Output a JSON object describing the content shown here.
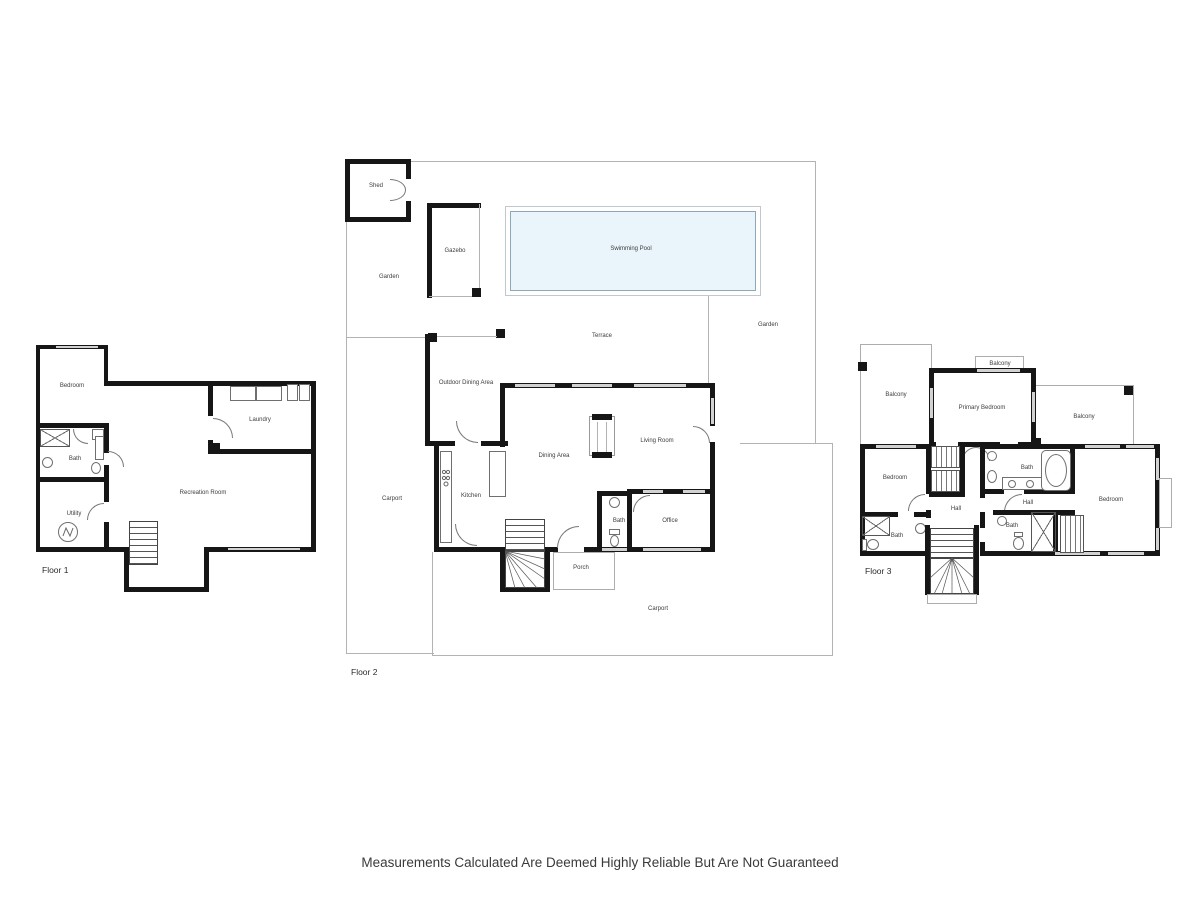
{
  "disclaimer": "Measurements Calculated Are Deemed Highly Reliable But Are Not Guaranteed",
  "floor1": {
    "name": "Floor 1",
    "rooms": {
      "bedroom": "Bedroom",
      "laundry": "Laundry",
      "bath": "Bath",
      "recreation_room": "Recreation Room",
      "utility": "Utility"
    }
  },
  "floor2": {
    "name": "Floor 2",
    "rooms": {
      "shed": "Shed",
      "gazebo": "Gazebo",
      "garden_left": "Garden",
      "swimming_pool": "Swimming Pool",
      "terrace": "Terrace",
      "garden_right": "Garden",
      "outdoor_dining_area": "Outdoor Dining Area",
      "kitchen": "Kitchen",
      "dining_area": "Dining Area",
      "living_room": "Living Room",
      "carport_left": "Carport",
      "bath": "Bath",
      "office": "Office",
      "porch": "Porch",
      "carport": "Carport"
    }
  },
  "floor3": {
    "name": "Floor 3",
    "rooms": {
      "balcony_left": "Balcony",
      "balcony_top": "Balcony",
      "primary_bedroom": "Primary Bedroom",
      "balcony_right": "Balcony",
      "bedroom_left": "Bedroom",
      "bath_mid": "Bath",
      "hall_left": "Hall",
      "hall_right": "Hall",
      "bath_left": "Bath",
      "bath_bottom": "Bath",
      "bedroom_right": "Bedroom"
    }
  },
  "colors": {
    "wall": "#161616",
    "boundary": "#b3b3b3",
    "window": "#d2d2d2",
    "pool_fill": "#e9f4fb",
    "pool_border": "#8fa8b8",
    "label": "#3d3d3d"
  }
}
